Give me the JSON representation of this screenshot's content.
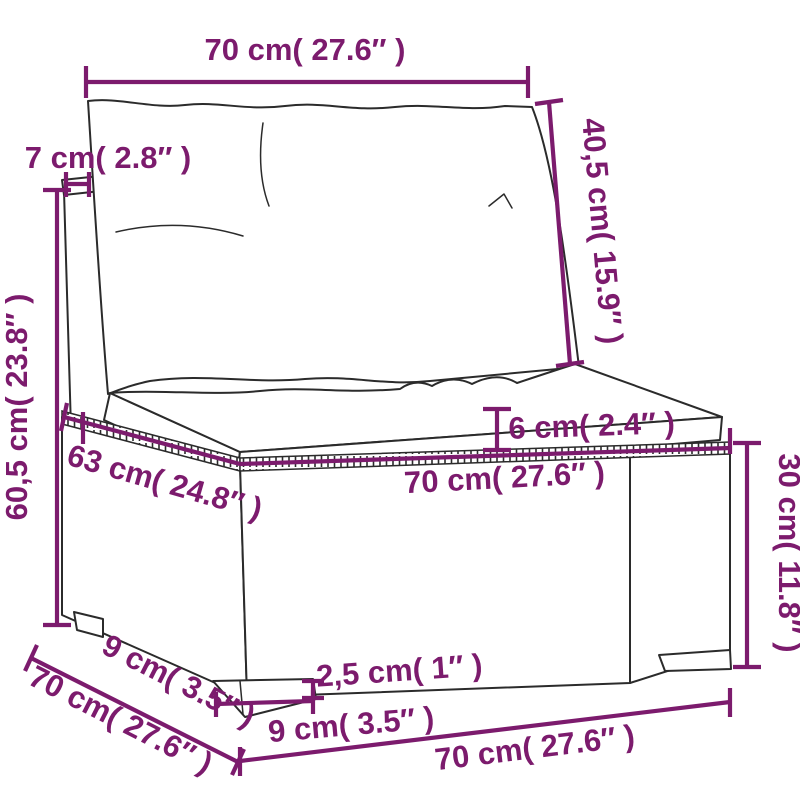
{
  "diagram": {
    "kind": "product-dimension-diagram",
    "product": "poly rattan garden sofa middle section with cushions",
    "accent_color": "#7C1B6D",
    "ink_color": "#2B2B2B",
    "background_color": "#FFFFFF"
  },
  "dimensions": {
    "back_width": "70 cm( 27.6″ )",
    "back_cushion_height": "40,5 cm( 15.9″ )",
    "post_top_width": "7 cm( 2.8″ )",
    "total_height": "60,5 cm( 23.8″ )",
    "seat_cushion_thickness": "6 cm( 2.4″ )",
    "seat_depth": "63 cm( 24.8″ )",
    "seat_width": "70 cm( 27.6″ )",
    "base_height": "30 cm( 11.8″ )",
    "total_depth": "70 cm( 27.6″ )",
    "leg_inset_depth": "9 cm( 3.5″ )",
    "leg_height": "2,5 cm( 1″ )",
    "leg_width": "9 cm( 3.5″ )",
    "base_width": "70 cm( 27.6″ )"
  }
}
